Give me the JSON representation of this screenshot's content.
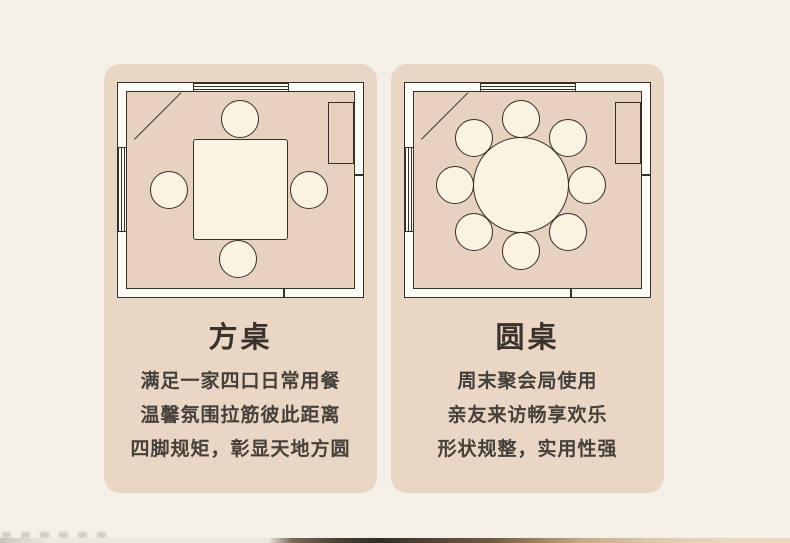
{
  "page": {
    "background_color": "#f4f0e8",
    "card_color": "#ead6c5",
    "outline_color": "#35302a",
    "wall_fill_color": "#fdfbf6",
    "furniture_fill_color": "#fbf2e1",
    "title_text_color": "#3a332c",
    "body_text_color": "#45403a"
  },
  "cards": [
    {
      "title": "方桌",
      "description": [
        "满足一家四口日常用餐",
        "温馨氛围拉筋彼此距离",
        "四脚规矩，彰显天地方圆"
      ],
      "plan": {
        "type": "floor-plan",
        "table_shape": "square",
        "seat_count": 4,
        "features": [
          "top-wall-window",
          "left-wall-window",
          "corner-door",
          "right-wall-cabinet"
        ]
      }
    },
    {
      "title": "圆桌",
      "description": [
        "周末聚会局使用",
        "亲友来访畅享欢乐",
        "形状规整，实用性强"
      ],
      "plan": {
        "type": "floor-plan",
        "table_shape": "round",
        "seat_count": 8,
        "features": [
          "top-wall-window",
          "left-wall-window",
          "corner-door",
          "right-wall-cabinet"
        ]
      }
    }
  ]
}
